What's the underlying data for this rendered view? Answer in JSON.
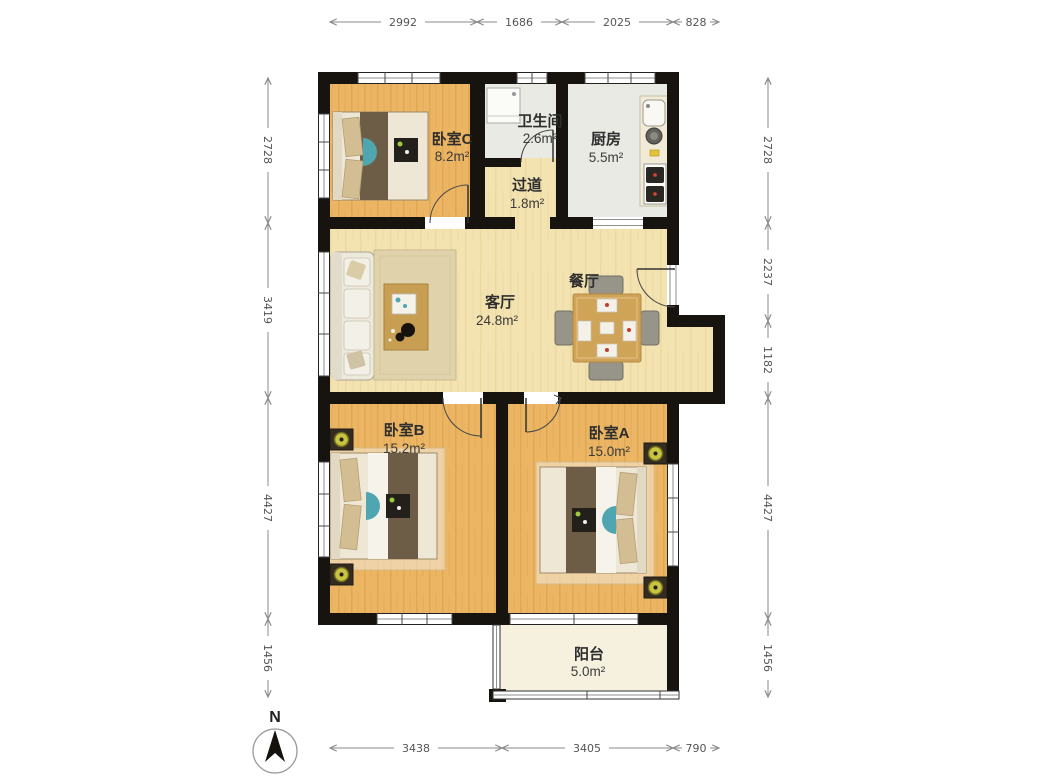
{
  "compass": {
    "label": "N"
  },
  "rooms": {
    "bedroom_c": {
      "name": "卧室C",
      "area": "8.2m²"
    },
    "bathroom": {
      "name": "卫生间",
      "area": "2.6m²"
    },
    "hallway": {
      "name": "过道",
      "area": "1.8m²"
    },
    "kitchen": {
      "name": "厨房",
      "area": "5.5m²"
    },
    "living": {
      "name": "客厅",
      "area": "24.8m²"
    },
    "dining": {
      "name": "餐厅"
    },
    "bedroom_b": {
      "name": "卧室B",
      "area": "15.2m²"
    },
    "bedroom_a": {
      "name": "卧室A",
      "area": "15.0m²"
    },
    "balcony": {
      "name": "阳台",
      "area": "5.0m²"
    }
  },
  "dimensions": {
    "top": [
      "2992",
      "1686",
      "2025",
      "828"
    ],
    "left": [
      "2728",
      "3419",
      "4427",
      "1456"
    ],
    "right": [
      "2728",
      "2237",
      "1182",
      "4427",
      "1456"
    ],
    "bottom": [
      "3438",
      "3405",
      "790"
    ]
  },
  "theme": {
    "wall": "#17140f",
    "wood_bedroom": "#ebb564",
    "wood_living": "#f3e3b1",
    "tile_floor": "#e9eae3",
    "balcony_floor": "#f6f1de",
    "accent_teal": "#4fa6b0",
    "bed_blanket": "#6e5d46",
    "wood_furniture": "#c79e52",
    "lamp_green": "#c9c43f",
    "dim_line": "#8a8a8a",
    "label_text": "#2e2e2e"
  }
}
